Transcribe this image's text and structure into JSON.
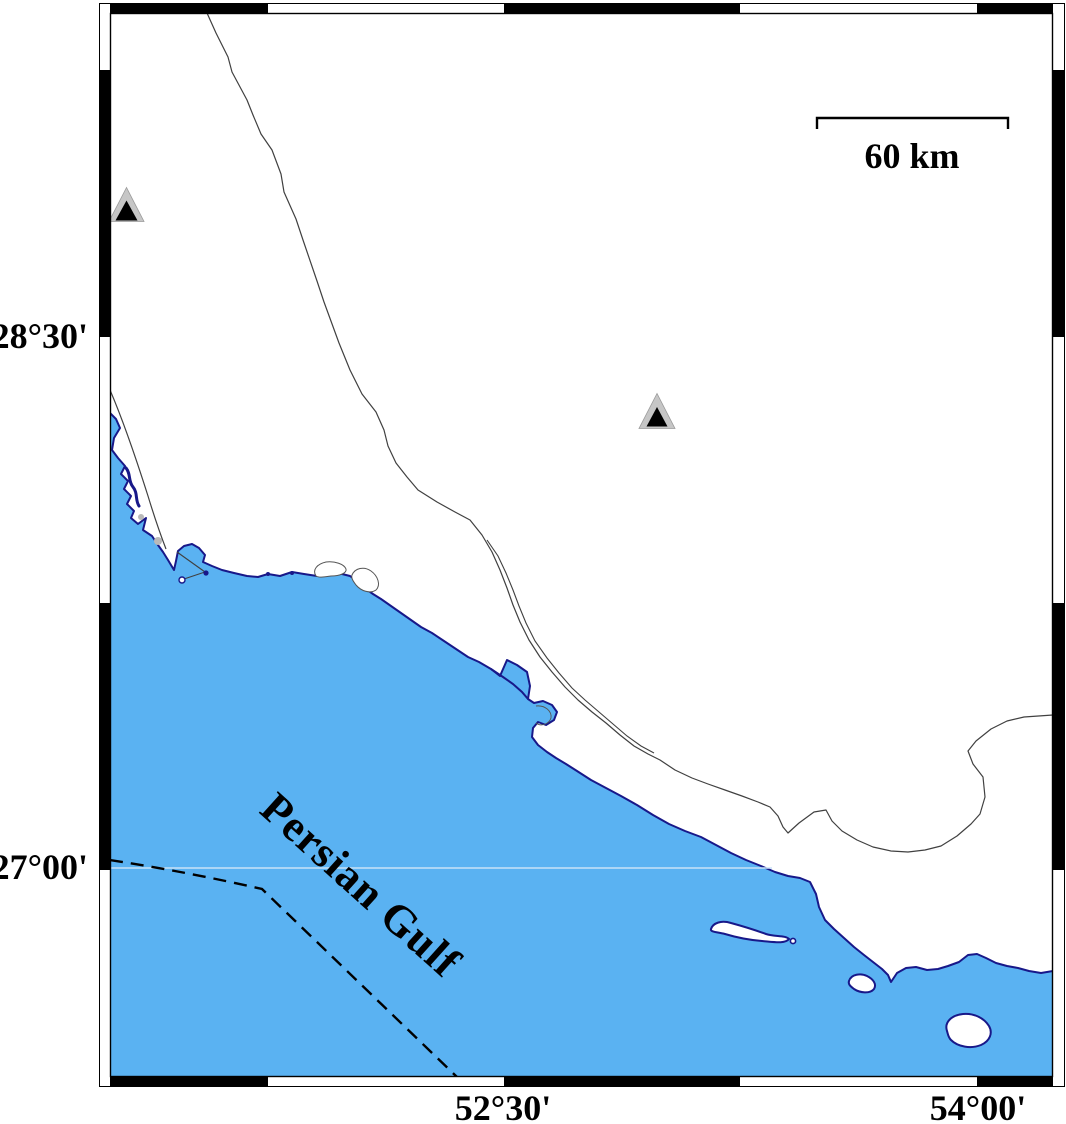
{
  "map": {
    "axis": {
      "lat_labels": [
        {
          "text": "28°30'"
        },
        {
          "text": "27°00'"
        }
      ],
      "lon_labels": [
        {
          "text": "52°30'"
        },
        {
          "text": "54°00'"
        }
      ]
    },
    "scale_bar": {
      "label": "60 km"
    },
    "sea_label": {
      "text": "Persian Gulf"
    },
    "markers": [
      {
        "name": "station-triangle-1",
        "symbol": "triangle"
      },
      {
        "name": "station-triangle-2",
        "symbol": "triangle"
      }
    ],
    "colors": {
      "sea": "#5ab2f2",
      "coastline": "#181889",
      "land": "#ffffff",
      "frame": "#000000",
      "boundary_dashed": "#000000",
      "road_line": "#404040",
      "triangle_halo": "#c6c6c6",
      "triangle_fill": "#000000",
      "latitude_faint_line": "#c8e2f8"
    }
  }
}
